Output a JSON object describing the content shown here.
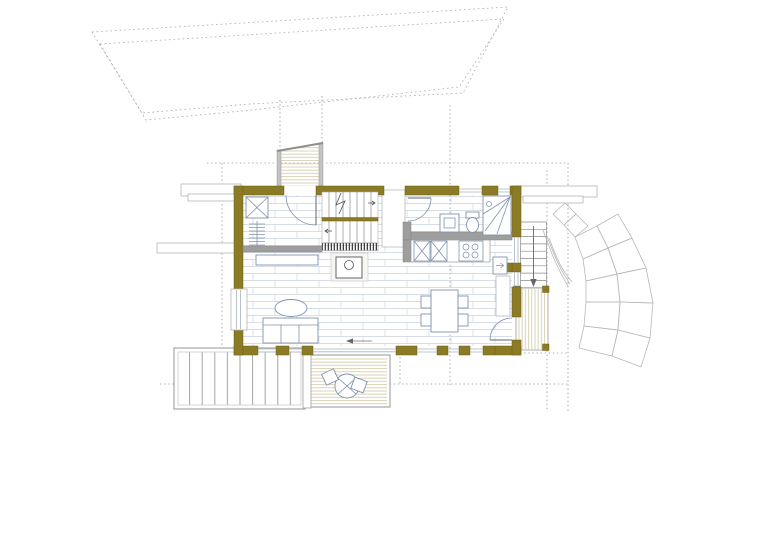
{
  "document": {
    "kind": "architectural floor plan with site context",
    "view": "top-down ground floor plan of a small house with decks, entry walkway and garden steps",
    "visible_text": []
  },
  "colors": {
    "background": "#ffffff",
    "wall": "#8c7b26",
    "wall_edge": "#6e6118",
    "partition": "#9e9e9e",
    "floor_joint": "#ccd4e0",
    "deck_board": "#cfc8a4",
    "furniture_line": "#8193ad",
    "step_line": "#9a9a9a",
    "reference_dotted": "#9198a1",
    "site_dotted": "#b7b2a8",
    "garden_step_line": "#b8b8b8",
    "glass_line": "#a8b0bd",
    "tick": "#3f3f3f"
  },
  "site": {
    "boundary": "irregular dotted band (road / stream) across the top",
    "reference_lines": "dotted setting-out grid lines around the building",
    "retaining_walls": [
      "northwest thin wall pair",
      "west long wall",
      "northeast thin wall pair"
    ]
  },
  "building": {
    "entry": [
      "entry-walkway (boarded ramp from north)",
      "entry-door with swing"
    ],
    "hall": [
      "wardrobe (x-box)",
      "coat-rack"
    ],
    "staircase": [
      "two flights with break line",
      "cut-line tick strip at base"
    ],
    "living_room": [
      "sideboard",
      "wood-stove with flue circle",
      "oval coffee-table",
      "three-seat sofa",
      "west window"
    ],
    "kitchen": [
      "L-counter",
      "two base cabinets (x-boxes)",
      "cooktop with 4 burners",
      "appliance with arrow",
      "east counter strip"
    ],
    "bathroom": [
      "door with swing",
      "washbasin",
      "toilet",
      "corner shower with drain"
    ],
    "dining": [
      "table with four chairs",
      "east door with swing",
      "sliding glass door with floor arrow"
    ],
    "outdoor": [
      "west wide garden steps",
      "south terrace deck with round table and two chairs",
      "east exterior stair with down arrow",
      "east landing deck with four posts",
      "curved fan of garden steps"
    ]
  }
}
